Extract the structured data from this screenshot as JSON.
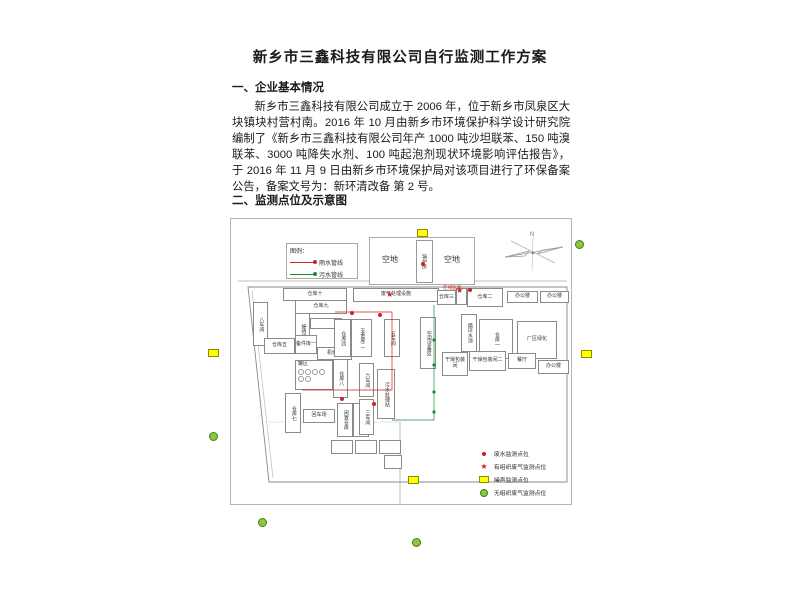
{
  "document": {
    "title": "新乡市三鑫科技有限公司自行监测工作方案",
    "section1_heading": "一、企业基本情况",
    "paragraph": "新乡市三鑫科技有限公司成立于 2006 年，位于新乡市凤泉区大块镇块村营村南。2016 年 10 月由新乡市环境保护科学设计研究院编制了《新乡市三鑫科技有限公司年产 1000 吨沙坦联苯、150 吨溴联苯、3000 吨降失水剂、100 吨起泡剂现状环境影响评估报告》，于 2016 年 11 月 9 日由新乡市环境保护局对该项目进行了环保备案公告，备案文号为：新环清改备 第 2 号。",
    "section2_heading": "二、监测点位及示意图"
  },
  "diagram": {
    "pipe_legend": {
      "title": "图例：",
      "items": [
        {
          "label": "雨水管线",
          "color": "#cc2222"
        },
        {
          "label": "污水管线",
          "color": "#1a8a3a"
        }
      ]
    },
    "open_land": {
      "left": "空地",
      "center": "锅炉房",
      "right": "空地"
    },
    "compass_label": "N",
    "buildings": [
      {
        "label": "仓库十",
        "x": 52,
        "y": 69,
        "w": 62,
        "h": 11
      },
      {
        "label": "仓库九",
        "x": 64,
        "y": 81,
        "w": 50,
        "h": 12
      },
      {
        "label": "八车间",
        "x": 22,
        "y": 83,
        "w": 13,
        "h": 42,
        "v": true
      },
      {
        "label": "接待间",
        "x": 64,
        "y": 94,
        "w": 13,
        "h": 34,
        "v": true
      },
      {
        "label": "",
        "x": 79,
        "y": 99,
        "w": 30,
        "h": 9
      },
      {
        "label": "仓库五",
        "x": 33,
        "y": 119,
        "w": 29,
        "h": 14
      },
      {
        "label": "备件库一",
        "x": 64,
        "y": 116,
        "w": 20,
        "h": 17
      },
      {
        "label": "机修间",
        "x": 86,
        "y": 128,
        "w": 33,
        "h": 11
      },
      {
        "label": "罐区",
        "x": 64,
        "y": 141,
        "w": 36,
        "h": 28,
        "tank": true
      },
      {
        "label": "仓库八",
        "x": 102,
        "y": 140,
        "w": 13,
        "h": 37,
        "v": true
      },
      {
        "label": "仓库七",
        "x": 54,
        "y": 174,
        "w": 14,
        "h": 38,
        "v": true
      },
      {
        "label": "回车场",
        "x": 72,
        "y": 190,
        "w": 30,
        "h": 12
      },
      {
        "label": "闲置仓库",
        "x": 106,
        "y": 184,
        "w": 14,
        "h": 32,
        "v": true
      },
      {
        "label": "仓库十一",
        "x": 122,
        "y": 184,
        "w": 14,
        "h": 32,
        "v": true
      },
      {
        "label": "废气处理设施",
        "x": 122,
        "y": 69,
        "w": 84,
        "h": 12
      },
      {
        "label": "仓库四",
        "x": 103,
        "y": 100,
        "w": 15,
        "h": 36,
        "v": true
      },
      {
        "label": "五金库二",
        "x": 120,
        "y": 100,
        "w": 19,
        "h": 36,
        "v": true
      },
      {
        "label": "五车间",
        "x": 153,
        "y": 100,
        "w": 14,
        "h": 36,
        "v": true
      },
      {
        "label": "空闲设备区",
        "x": 189,
        "y": 98,
        "w": 14,
        "h": 50,
        "v": true
      },
      {
        "label": "六车间",
        "x": 128,
        "y": 144,
        "w": 13,
        "h": 32,
        "v": true
      },
      {
        "label": "三车间",
        "x": 128,
        "y": 180,
        "w": 13,
        "h": 34,
        "v": true
      },
      {
        "label": "污水处理站",
        "x": 146,
        "y": 150,
        "w": 16,
        "h": 48,
        "v": true
      },
      {
        "label": "仓库三",
        "x": 206,
        "y": 71,
        "w": 17,
        "h": 13
      },
      {
        "label": "",
        "x": 225,
        "y": 69,
        "w": 9,
        "h": 15
      },
      {
        "label": "仓库二",
        "x": 236,
        "y": 69,
        "w": 34,
        "h": 17
      },
      {
        "label": "办公楼",
        "x": 276,
        "y": 72,
        "w": 29,
        "h": 10
      },
      {
        "label": "办公楼",
        "x": 309,
        "y": 72,
        "w": 27,
        "h": 10
      },
      {
        "label": "循环水池",
        "x": 230,
        "y": 95,
        "w": 14,
        "h": 36,
        "v": true
      },
      {
        "label": "仓库一",
        "x": 248,
        "y": 100,
        "w": 32,
        "h": 38,
        "v": true
      },
      {
        "label": "厂区绿化",
        "x": 286,
        "y": 102,
        "w": 38,
        "h": 36
      },
      {
        "label": "干燥包装间",
        "x": 211,
        "y": 133,
        "w": 24,
        "h": 22
      },
      {
        "label": "干燥包装间二",
        "x": 238,
        "y": 132,
        "w": 35,
        "h": 18
      },
      {
        "label": "餐厅",
        "x": 277,
        "y": 134,
        "w": 26,
        "h": 14
      },
      {
        "label": "办公楼",
        "x": 307,
        "y": 141,
        "w": 29,
        "h": 12
      },
      {
        "label": "",
        "x": 100,
        "y": 221,
        "w": 20,
        "h": 12
      },
      {
        "label": "",
        "x": 124,
        "y": 221,
        "w": 20,
        "h": 12
      },
      {
        "label": "",
        "x": 148,
        "y": 221,
        "w": 20,
        "h": 12
      },
      {
        "label": "",
        "x": 153,
        "y": 236,
        "w": 16,
        "h": 12
      }
    ],
    "annotations": [
      {
        "text": "在线监测",
        "x": 443,
        "y": 285
      }
    ],
    "point_legend": [
      {
        "symbol": "dot",
        "label": "废水监测点位"
      },
      {
        "symbol": "star",
        "label": "有组织废气监测点位"
      },
      {
        "symbol": "noise-rect",
        "label": "噪声监测点位"
      },
      {
        "symbol": "gas-circle",
        "label": "无组织废气监测点位"
      }
    ],
    "markers": {
      "noise": [
        [
          417,
          229
        ],
        [
          208,
          349
        ],
        [
          581,
          350
        ],
        [
          408,
          476
        ]
      ],
      "fugitive_gas": [
        [
          575,
          240
        ],
        [
          209,
          432
        ],
        [
          258,
          518
        ],
        [
          412,
          538
        ]
      ],
      "wastewater": [
        [
          421,
          262
        ],
        [
          350,
          311
        ],
        [
          378,
          313
        ],
        [
          340,
          397
        ],
        [
          372,
          402
        ],
        [
          468,
          288
        ]
      ],
      "stack_gas": [
        [
          386,
          291
        ],
        [
          456,
          287
        ]
      ]
    },
    "pipelines": [
      {
        "color": "#cc2222",
        "points": [
          [
            335,
            312
          ],
          [
            392,
            312
          ],
          [
            392,
            390
          ],
          [
            302,
            390
          ]
        ]
      },
      {
        "color": "#1a8a3a",
        "points": [
          [
            434,
            305
          ],
          [
            434,
            420
          ],
          [
            392,
            420
          ]
        ]
      }
    ],
    "colors": {
      "rain_pipe": "#cc2222",
      "sewage_pipe": "#1a8a3a",
      "noise_marker": "#ffff00",
      "fugitive_gas_marker": "#8dc63f",
      "point_red": "#cc2222"
    }
  }
}
